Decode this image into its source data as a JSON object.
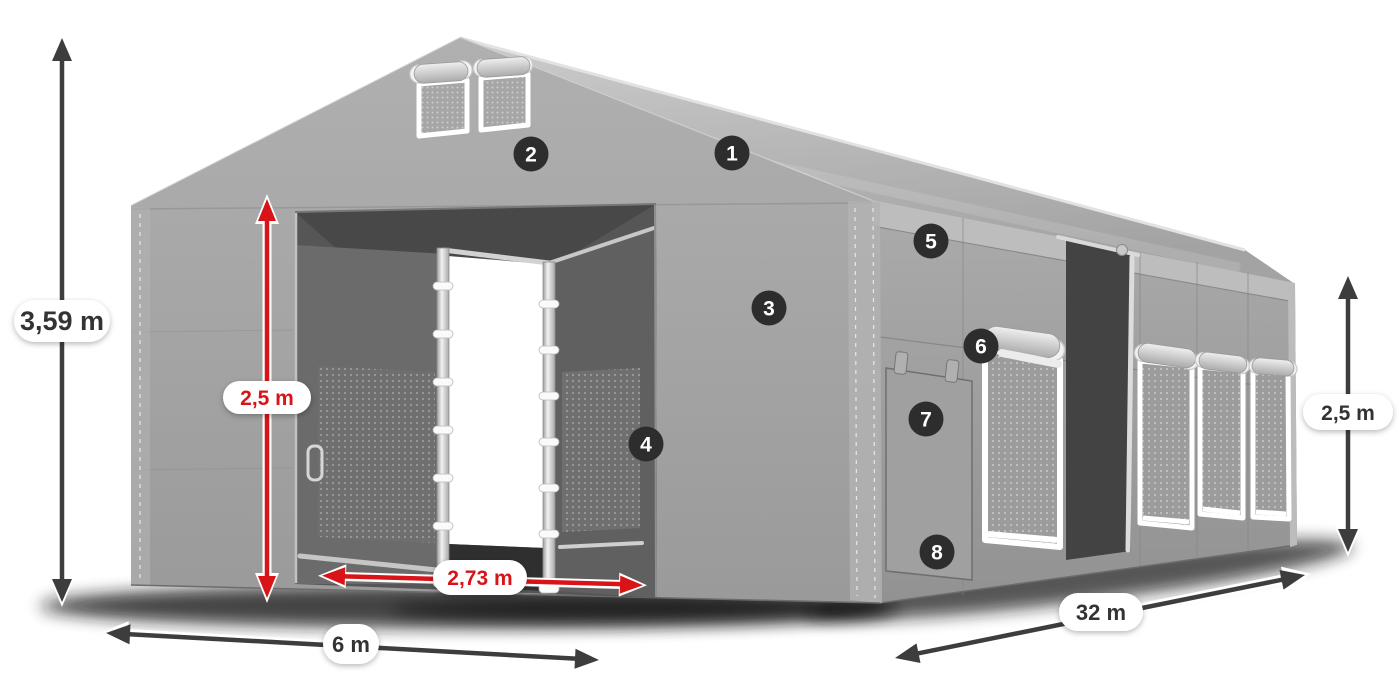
{
  "page_bg": "#ffffff",
  "colors": {
    "page_bg": "#ffffff",
    "accent_red": "#d81419",
    "dimension_dark": "#3d3d3d",
    "badge_bg": "#2d2d2d",
    "badge_text": "#ffffff",
    "pill_bg": "#ffffff",
    "tent_light": "#c6c6c6",
    "tent_mid": "#a5a5a5",
    "tent_interior": "#565656"
  },
  "dimensions": {
    "front_height": "3,59 m",
    "door_height": "2,5 m",
    "door_width": "2,73 m",
    "front_width": "6 m",
    "side_length": "32 m",
    "side_height": "2,5 m"
  },
  "badges": [
    "1",
    "2",
    "3",
    "4",
    "5",
    "6",
    "7",
    "8"
  ]
}
